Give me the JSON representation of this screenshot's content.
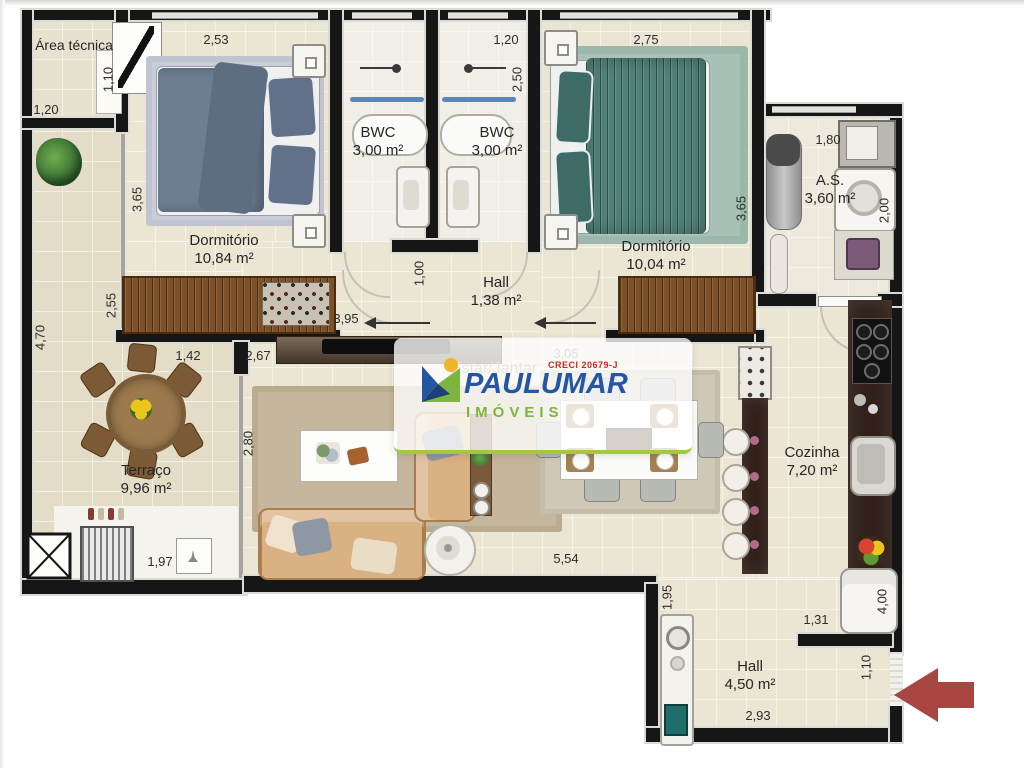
{
  "watermark": {
    "brand": "PAULUMAR",
    "subtitle": "IMÓVEIS",
    "creci": "CRECI 20679-J",
    "brand_color": "#2456a4",
    "subtitle_color": "#7cb63f",
    "creci_color": "#c22a22"
  },
  "plan": {
    "colors": {
      "wall": "#161616",
      "floor": "#ebe5d4",
      "terrace_floor": "#e3dcc6",
      "counter_wood": "#32211a",
      "closet_wood": "#7d5027",
      "bed1_blanket": "#6e7e92",
      "bed2_blanket": "#51807a",
      "entry_arrow": "#a84642"
    },
    "rooms": {
      "area_tecnica": {
        "name": "Área técnica"
      },
      "dormitorio1": {
        "name": "Dormitório",
        "area": "10,84 m²"
      },
      "bwc1": {
        "name": "BWC",
        "area": "3,00 m²"
      },
      "bwc2": {
        "name": "BWC",
        "area": "3,00 m²"
      },
      "dormitorio2": {
        "name": "Dormitório",
        "area": "10,04 m²"
      },
      "hall_upper": {
        "name": "Hall",
        "area": "1,38 m²"
      },
      "servico": {
        "name": "A.S.",
        "area": "3,60 m²"
      },
      "cozinha": {
        "name": "Cozinha",
        "area": "7,20 m²"
      },
      "terraco": {
        "name": "Terraço",
        "area": "9,96 m²"
      },
      "estar": {
        "name": "Estar/Jantar"
      },
      "hall_lower": {
        "name": "Hall",
        "area": "4,50 m²"
      }
    },
    "dims": {
      "at_h": "1,10",
      "at_w": "1,20",
      "dorm1_w": "2,53",
      "dorm1_h": "3,65",
      "dorm1_door": "3,95",
      "bwc_w": "1,20",
      "bwc_h": "2,50",
      "dorm2_w": "2,75",
      "dorm2_h": "3,65",
      "as_w": "1,80",
      "as_h": "2,00",
      "hall_upper_h": "1,00",
      "terraco_h": "4,70",
      "terraco_wall": "2,55",
      "estar_a": "1,42",
      "estar_b": "2,67",
      "estar_w": "3,05",
      "estar_glass": "2,80",
      "nook_w": "1,97",
      "estar_bottom": "5,54",
      "hall_lower_h": "1,95",
      "cozinha_wall": "1,31",
      "cozinha_h": "4,00",
      "entry_w": "1,10",
      "hall_lower_w": "2,93"
    }
  }
}
